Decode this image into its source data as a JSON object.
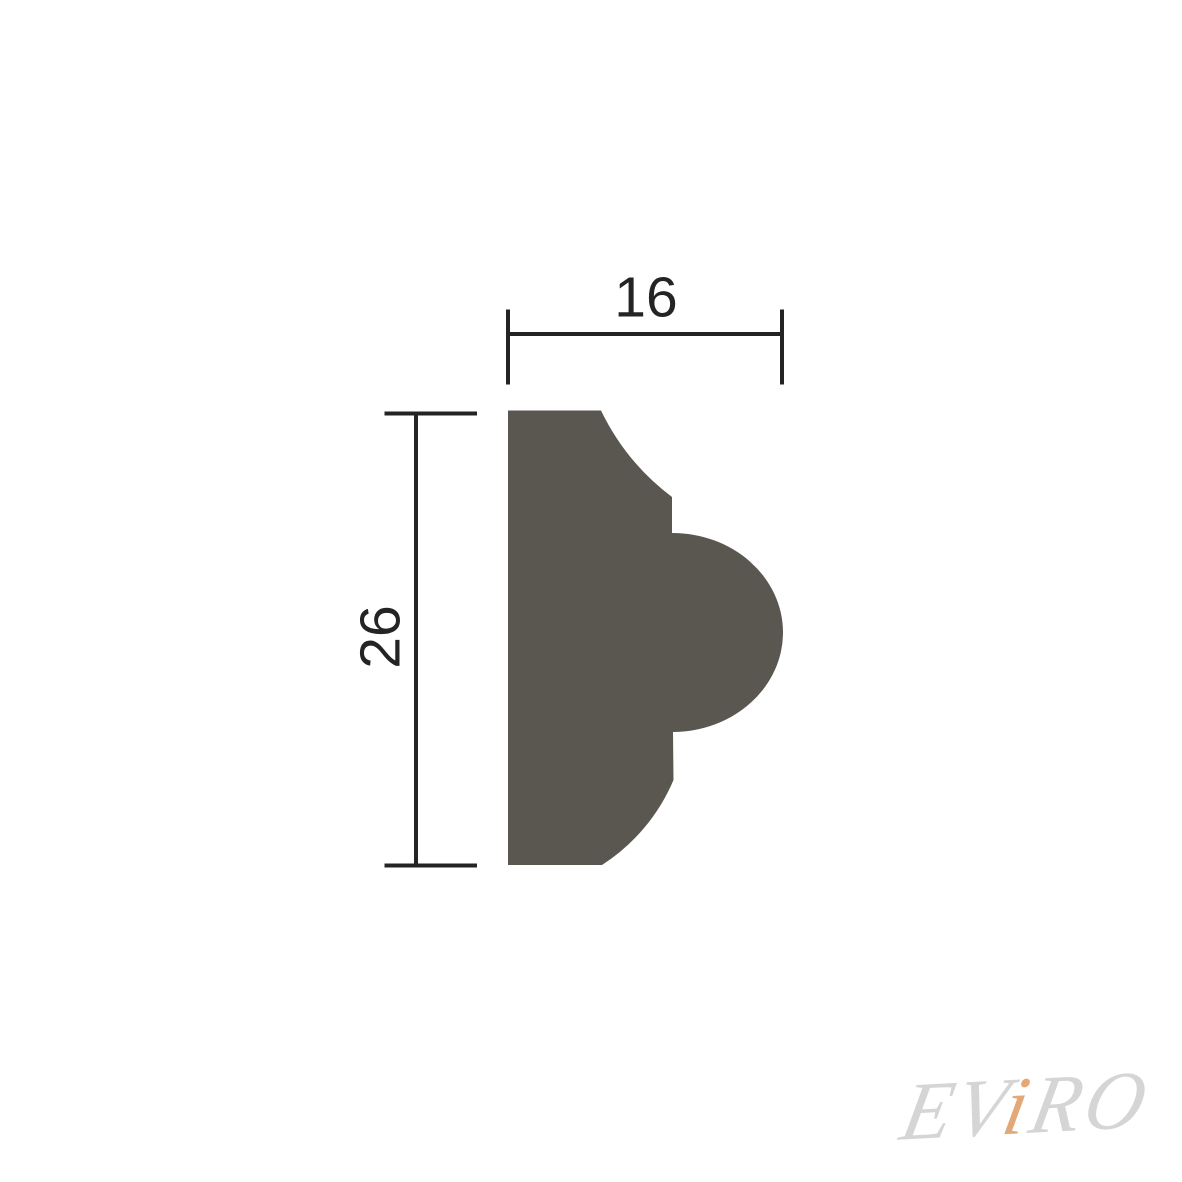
{
  "drawing": {
    "fill_color": "#5a5751",
    "line_color": "#242424",
    "dimensions": {
      "width": {
        "label": "16",
        "value": 16
      },
      "height": {
        "label": "26",
        "value": 26
      }
    }
  },
  "watermark": {
    "text": "EViRO",
    "part_ev": "EV",
    "part_i": "i",
    "part_ro": "RO",
    "gray_color": "#d5d5d5",
    "accent_color": "#e2a877"
  }
}
